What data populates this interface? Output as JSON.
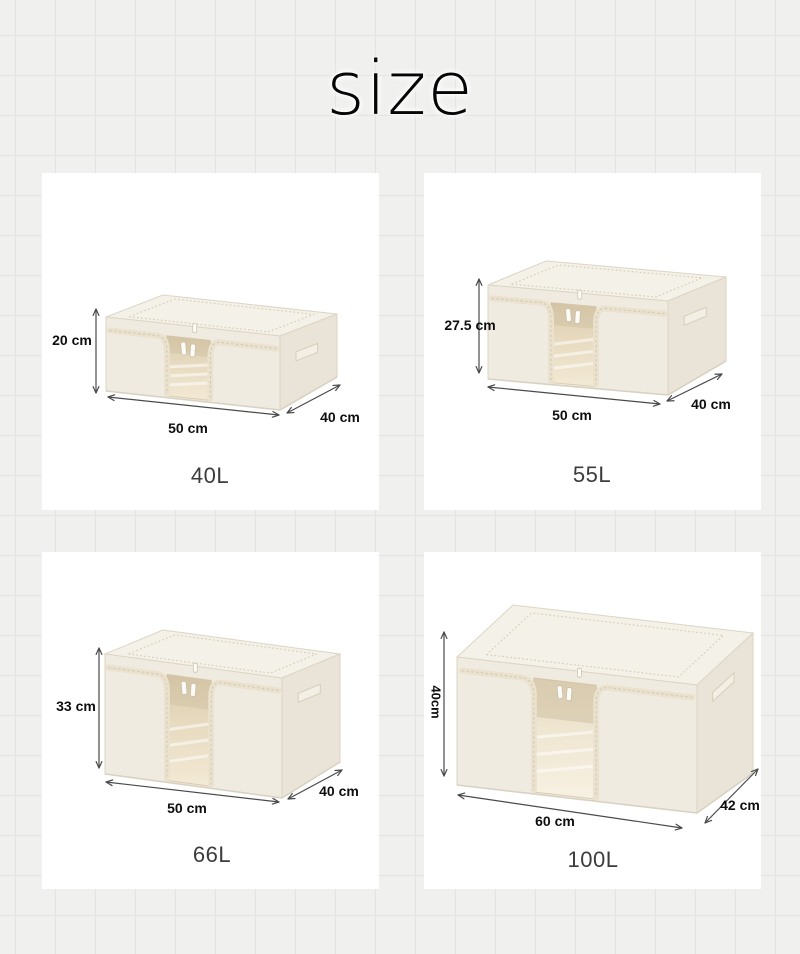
{
  "title": "size",
  "theme": {
    "arrow_color": "#4a4a4a",
    "label_color": "#0e0e0e",
    "volume_color": "#3c3c3c",
    "panel_bg": "#ffffff",
    "page_bg": "#f0f0ee",
    "grid_line": "#e3e3e1",
    "box_colors": {
      "top": "#f4f1e9",
      "front": "#f0ebe1",
      "side": "#e9e4d7",
      "edge": "#ddd5c4",
      "tape": "#eae2cf",
      "seam": "#d2c7ab",
      "pull": "#fcfbf7",
      "window_top": "#dccdae",
      "window_bottom": "#f3ead5",
      "window_top_light": "#e9ddc3",
      "window_bottom_light": "#f7f1e3",
      "shade": "#b9a987",
      "streak": "#ffffff"
    }
  },
  "panels": [
    {
      "volume_label": "40L",
      "height_label": "20 cm",
      "width_label": "50 cm",
      "depth_label": "40 cm",
      "rotated_height_label": false,
      "geometry": {
        "x": 64,
        "yb": 218,
        "w": 174,
        "slope": 19,
        "h": 74,
        "dx": 57,
        "dy": 22,
        "dy2": 33,
        "win": [
          0.35,
          0.6
        ],
        "interior": "normal"
      },
      "arrows": {
        "height": [
          54,
          136,
          54,
          220
        ],
        "width": [
          66,
          224,
          237,
          242
        ],
        "depth": [
          245,
          240,
          298,
          212
        ]
      },
      "label_pos": {
        "height": [
          30,
          167
        ],
        "width": [
          146,
          255
        ],
        "depth": [
          298,
          244
        ],
        "volume": [
          168,
          303
        ]
      }
    },
    {
      "volume_label": "55L",
      "height_label": "27.5 cm",
      "width_label": "50 cm",
      "depth_label": "40 cm",
      "rotated_height_label": false,
      "geometry": {
        "x": 64,
        "yb": 206,
        "w": 180,
        "slope": 16,
        "h": 94,
        "dx": 58,
        "dy": 24,
        "dy2": 34,
        "win": [
          0.35,
          0.6
        ],
        "interior": "normal"
      },
      "arrows": {
        "height": [
          55,
          106,
          55,
          200
        ],
        "width": [
          64,
          214,
          236,
          231
        ],
        "depth": [
          243,
          228,
          298,
          201
        ]
      },
      "label_pos": {
        "height": [
          46,
          152
        ],
        "width": [
          148,
          242
        ],
        "depth": [
          287,
          231
        ],
        "volume": [
          168,
          302
        ]
      }
    },
    {
      "volume_label": "66L",
      "height_label": "33 cm",
      "width_label": "50 cm",
      "depth_label": "40 cm",
      "rotated_height_label": false,
      "geometry": {
        "x": 63,
        "yb": 222,
        "w": 177,
        "slope": 24,
        "h": 120,
        "dx": 58,
        "dy": 24,
        "dy2": 36,
        "win": [
          0.35,
          0.6
        ],
        "interior": "normal"
      },
      "arrows": {
        "height": [
          57,
          96,
          57,
          216
        ],
        "width": [
          64,
          230,
          237,
          250
        ],
        "depth": [
          246,
          247,
          300,
          218
        ]
      },
      "label_pos": {
        "height": [
          34,
          154
        ],
        "width": [
          145,
          256
        ],
        "depth": [
          297,
          239
        ],
        "volume": [
          170,
          303
        ]
      }
    },
    {
      "volume_label": "100L",
      "height_label": "40cm",
      "width_label": "60 cm",
      "depth_label": "42 cm",
      "rotated_height_label": true,
      "geometry": {
        "x": 33,
        "yb": 233,
        "w": 240,
        "slope": 28,
        "h": 128,
        "dx": 56,
        "dy": 52,
        "dy2": 40,
        "win": [
          0.32,
          0.58
        ],
        "interior": "light"
      },
      "arrows": {
        "height": [
          20,
          80,
          20,
          224
        ],
        "width": [
          34,
          243,
          258,
          276
        ],
        "depth": [
          281,
          271,
          334,
          217
        ]
      },
      "label_pos": {
        "height": [
          12,
          150
        ],
        "width": [
          131,
          269
        ],
        "depth": [
          316,
          253
        ],
        "volume": [
          169,
          308
        ]
      }
    }
  ]
}
